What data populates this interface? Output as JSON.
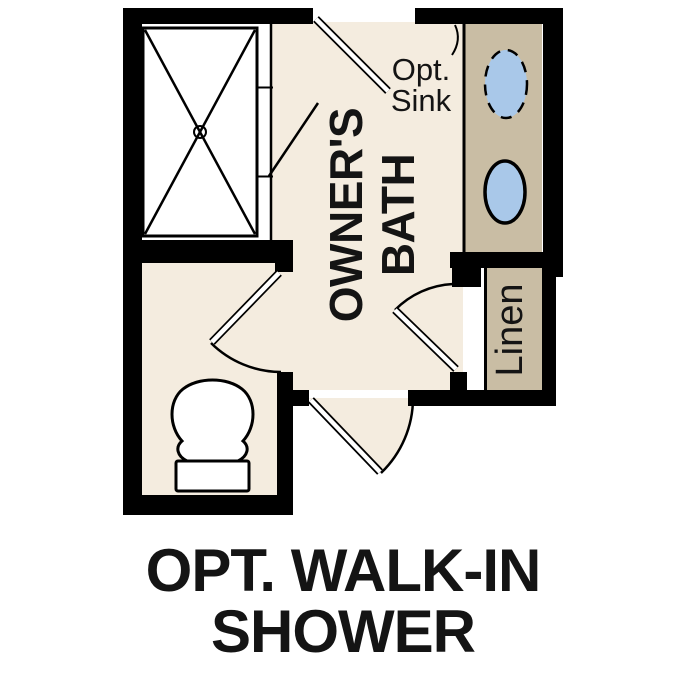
{
  "palette": {
    "wall": "#000000",
    "floor_cream": "#f4ecdf",
    "counter_tan": "#c9bda4",
    "fixture_blue": "#a9c8e9",
    "shower_floor": "#ffffff",
    "text_color": "#141414",
    "background": "#ffffff"
  },
  "labels": {
    "room_line1": "OWNER'S",
    "room_line2": "BATH",
    "opt_sink_line1": "Opt.",
    "opt_sink_line2": "Sink",
    "linen": "Linen"
  },
  "caption": {
    "line1": "OPT. WALK-IN",
    "line2": "SHOWER"
  },
  "fixtures": [
    "walk-in-shower-pan-icon",
    "shower-drain-icon",
    "optional-sink-icon",
    "sink-icon",
    "toilet-icon",
    "vanity-counter",
    "linen-shelf"
  ]
}
